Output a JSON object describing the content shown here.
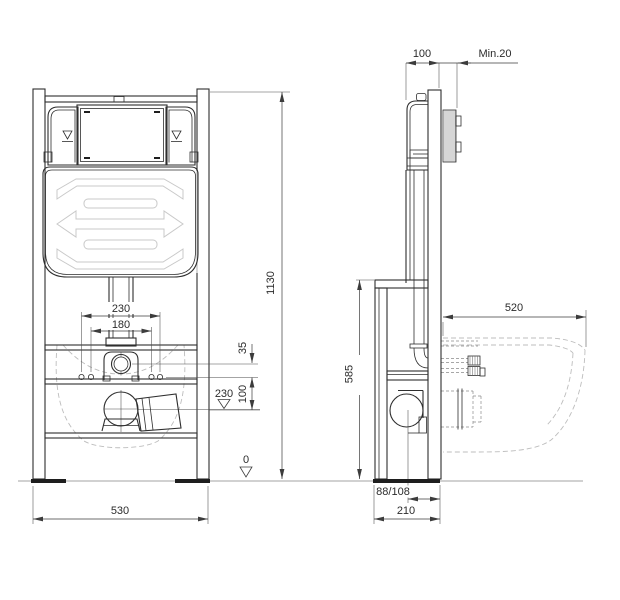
{
  "drawing": {
    "type": "wc-installation-frame-technical-diagram",
    "front_view": {
      "dim_bolt_spacing_outer": "230",
      "dim_bolt_spacing_inner": "180",
      "dim_rail_to_inlet": "35",
      "dim_inlet_to_outlet": "100",
      "dim_level_outlet": "230",
      "dim_level_floor": "0",
      "dim_total_height": "1130",
      "dim_total_width": "530"
    },
    "side_view": {
      "dim_cistern_depth": "100",
      "dim_wall_cover_min": "Min.20",
      "dim_support_height": "585",
      "dim_bowl_projection": "520",
      "dim_outlet_offset": "88/108",
      "dim_frame_depth": "210"
    },
    "colors": {
      "background": "#ffffff",
      "structure_line": "#2e2e2e",
      "dimension_line": "#3c3c3c",
      "light_detail": "#c9c9c9",
      "ground_line": "#a3a3a3"
    }
  }
}
